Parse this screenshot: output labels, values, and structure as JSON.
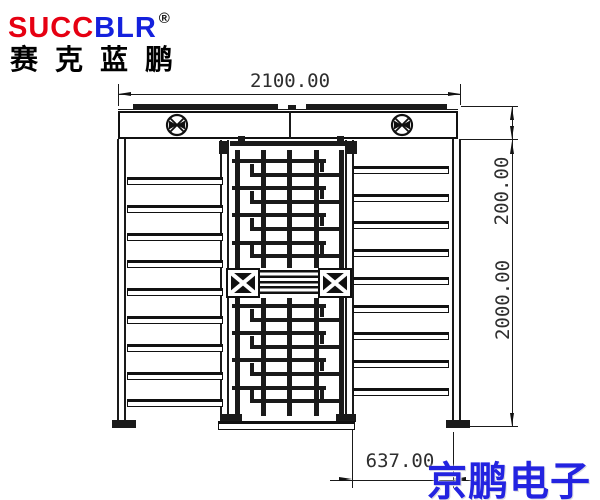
{
  "logo": {
    "brand_part1": "SUCC",
    "brand_part2": "BLR",
    "registered": "®",
    "subtitle": "赛克蓝鹏"
  },
  "dimensions": {
    "top_width": "2100.00",
    "header_height": "200.00",
    "body_height": "2000.00",
    "passage_width": "637.00"
  },
  "watermark": {
    "text": "京鹏电子"
  },
  "icons": {
    "header_left": "circled-x-icon",
    "header_right": "circled-x-icon",
    "reader_left": "crossed-box-icon",
    "reader_right": "crossed-box-icon"
  },
  "colors": {
    "brand_red": "#e60012",
    "brand_blue": "#1421dd",
    "watermark_blue": "#2323e0",
    "line": "#1a1a1a"
  }
}
